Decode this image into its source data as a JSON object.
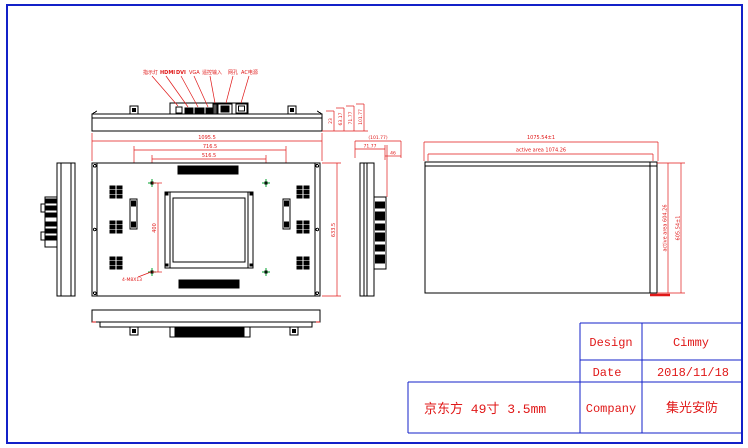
{
  "colors": {
    "line": "#000000",
    "dimension_red": "#e01818",
    "frame_blue": "#1321c8",
    "marker_green": "#00a32e",
    "background": "#ffffff"
  },
  "top_view": {
    "connector_labels": [
      "指示灯",
      "HDMI",
      "DVI",
      "VGA",
      "遥控输入",
      "网孔",
      "AC电源"
    ],
    "depth_dims": [
      "23",
      "63.17",
      "71.77",
      "101.77"
    ]
  },
  "dimensions": {
    "overall_width": "1095.5",
    "mount_width": "716.5",
    "vesa_width": "516.5",
    "vesa_height": "400",
    "overall_height": "633.5",
    "screw_note": "4-M8X13",
    "bracket_overall": "(101.77)",
    "bracket_depth": "71.77",
    "bracket_offset": "46"
  },
  "panel_view": {
    "outline_width": "1075.54±1",
    "active_width": "active area 1074.26",
    "active_height": "active area 604.26",
    "outline_height": "605.54±1"
  },
  "title_block": {
    "design_label": "Design",
    "design_value": "Cimmy",
    "date_label": "Date",
    "date_value": "2018/11/18",
    "company_label": "Company",
    "company_value": "集光安防",
    "note": "京东方 49寸 3.5mm"
  }
}
